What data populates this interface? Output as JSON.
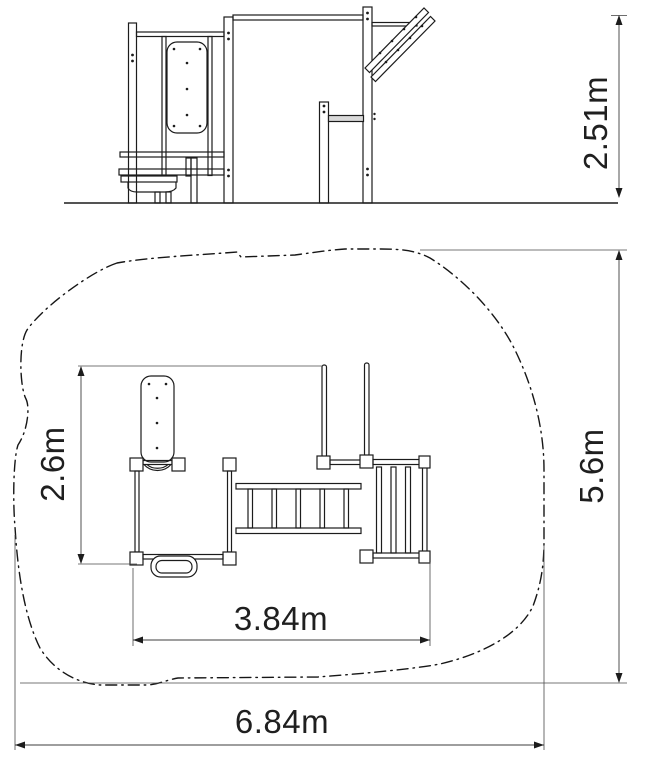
{
  "diagram": {
    "type": "technical-dimension-drawing",
    "subject": "outdoor-fitness-playground-equipment",
    "views": {
      "top": "side-elevation",
      "bottom": "plan-view-with-safety-zone"
    },
    "unit": "m",
    "dimensions": [
      {
        "id": "overall-height",
        "value": 2.51,
        "unit": "m",
        "label": "2.51m",
        "view": "elevation",
        "orientation": "vertical"
      },
      {
        "id": "equipment-depth",
        "value": 2.6,
        "unit": "m",
        "label": "2.6m",
        "view": "plan",
        "orientation": "vertical"
      },
      {
        "id": "equipment-width",
        "value": 3.84,
        "unit": "m",
        "label": "3.84m",
        "view": "plan",
        "orientation": "horizontal"
      },
      {
        "id": "safety-zone-depth",
        "value": 5.6,
        "unit": "m",
        "label": "5.6m",
        "view": "plan",
        "orientation": "vertical"
      },
      {
        "id": "safety-zone-width",
        "value": 6.84,
        "unit": "m",
        "label": "6.84m",
        "view": "plan",
        "orientation": "horizontal"
      }
    ],
    "colors": {
      "background": "#ffffff",
      "structure_line": "#1c1c1c",
      "dimension_line": "#3d3d3d"
    }
  }
}
